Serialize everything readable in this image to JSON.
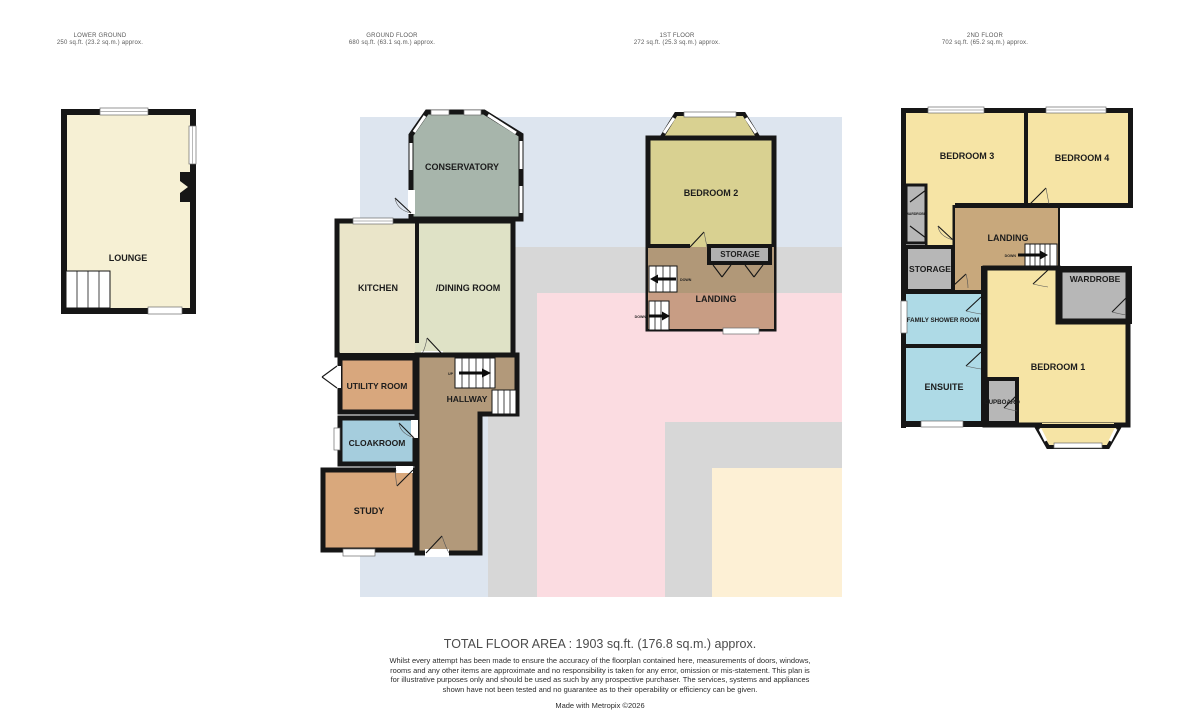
{
  "floors": [
    {
      "title": "LOWER GROUND",
      "area": "250 sq.ft. (23.2 sq.m.) approx."
    },
    {
      "title": "GROUND FLOOR",
      "area": "680 sq.ft. (63.1 sq.m.) approx."
    },
    {
      "title": "1ST FLOOR",
      "area": "272 sq.ft. (25.3 sq.m.) approx."
    },
    {
      "title": "2ND FLOOR",
      "area": "702 sq.ft. (65.2 sq.m.) approx."
    }
  ],
  "rooms": {
    "lounge": "LOUNGE",
    "conservatory": "CONSERVATORY",
    "kitchen": "KITCHEN",
    "dining_room": "/DINING ROOM",
    "utility_room": "UTILITY ROOM",
    "hallway": "HALLWAY",
    "cloakroom": "CLOAKROOM",
    "study": "STUDY",
    "bedroom2": "BEDROOM 2",
    "storage_first": "STORAGE",
    "landing_first": "LANDING",
    "bedroom3": "BEDROOM 3",
    "bedroom4": "BEDROOM 4",
    "wardrobe_small": "WARDROBE",
    "landing_second": "LANDING",
    "storage_second": "STORAGE",
    "family_shower_room": "FAMILY SHOWER ROOM",
    "ensuite": "ENSUITE",
    "bedroom1": "BEDROOM 1",
    "wardrobe": "WARDROBE",
    "cupboard": "CUPBOARD"
  },
  "stair_labels": {
    "up": "UP",
    "down": "DOWN"
  },
  "footer": {
    "total": "TOTAL FLOOR AREA : 1903 sq.ft. (176.8 sq.m.) approx.",
    "disclaimer": "Whilst every attempt has been made to ensure the accuracy of the floorplan contained here, measurements of doors, windows, rooms and any other items are approximate and no responsibility is taken for any error, omission or mis-statement. This plan is for illustrative purposes only and should be used as such by any prospective purchaser. The services, systems and appliances shown have not been tested and no guarantee as to their operability or efficiency can be given.",
    "made_with": "Made with Metropix ©2026"
  },
  "colors": {
    "wall": "#161616",
    "overlay_blue": "#dde5ef",
    "overlay_grey": "#d7d7d7",
    "overlay_pink": "#fbdce1",
    "overlay_cream": "#fdf0d5",
    "lounge": "#f6f0d4",
    "conservatory": "#a7b5ab",
    "kitchen": "#eae5c9",
    "dining": "#dfe2c6",
    "utility": "#d8a77d",
    "cloakroom": "#a5cddd",
    "study": "#d9a87c",
    "hallway": "#b2997a",
    "bedroom2": "#d9d191",
    "landing1_top": "#b19878",
    "landing1_bottom": "#c89d84",
    "storage_grey": "#b0b0b0",
    "bedroom_yellow": "#f6e4a5",
    "landing2": "#c8a87c",
    "closet_grey": "#b7b7b7",
    "bathroom_blue": "#aedae6"
  }
}
